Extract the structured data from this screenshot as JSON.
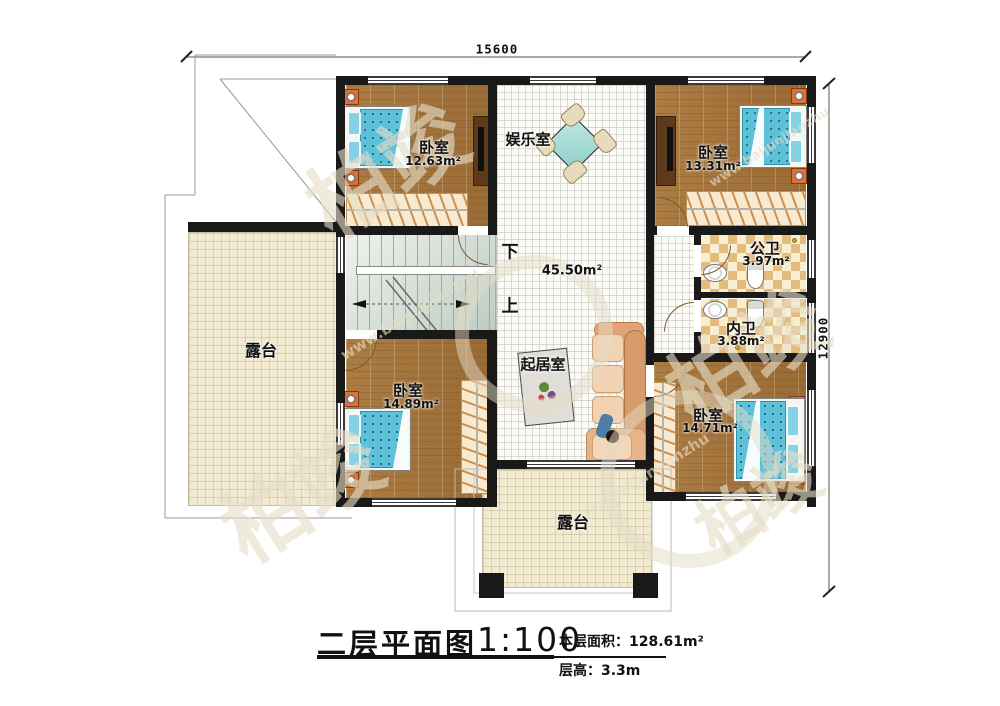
{
  "title": {
    "plan_name": "二层平面图",
    "scale": "1:100",
    "floor_area_label": "本层面积：",
    "floor_area_value": "128.61m²",
    "floor_height_label": "层高：",
    "floor_height_value": "3.3m"
  },
  "dimensions": {
    "width": "15600",
    "height": "12900"
  },
  "stairs": {
    "down_label": "下",
    "up_label": "上"
  },
  "rooms": {
    "bedroom_top_left": {
      "name": "卧室",
      "area": "12.63m²"
    },
    "entertainment": {
      "name": "娱乐室"
    },
    "bedroom_top_right": {
      "name": "卧室",
      "area": "13.31m²"
    },
    "public_bathroom": {
      "name": "公卫",
      "area": "3.97m²"
    },
    "private_bathroom": {
      "name": "内卫",
      "area": "3.88m²"
    },
    "living_room": {
      "name": "起居室",
      "area": "45.50m²"
    },
    "bedroom_bottom_left": {
      "name": "卧室",
      "area": "14.89m²"
    },
    "bedroom_bottom_right": {
      "name": "卧室",
      "area": "14.71m²"
    },
    "terrace_left": {
      "name": "露台"
    },
    "terrace_bottom": {
      "name": "露台"
    }
  },
  "watermark": {
    "brand": "柏竣",
    "url": "www.baijunjianzhu"
  },
  "colors": {
    "wall": "#191919",
    "wood_floor": "#a5773f",
    "bed_blue": "#5ec1da",
    "accent_orange": "#df6f33",
    "terrace_beige": "#f1ead1",
    "bath_tile": "#e2bb7d"
  }
}
